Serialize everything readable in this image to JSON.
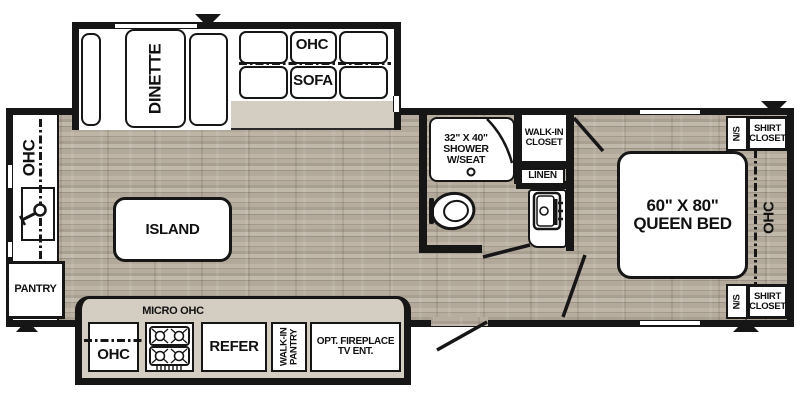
{
  "type": "rv-travel-trailer-floorplan",
  "colors": {
    "wall": "#161616",
    "floor_wood": "#b2a99c",
    "counter_tan": "#d4cec2",
    "interior_white": "#ffffff"
  },
  "labels": {
    "dinette": "DINETTE",
    "sofa_area": {
      "ohc": "OHC",
      "sofa": "SOFA"
    },
    "front": {
      "ohc": "OHC",
      "pantry": "PANTRY"
    },
    "kitchen": {
      "island": "ISLAND",
      "micro_ohc": "MICRO OHC",
      "ohc": "OHC",
      "refer": "REFER",
      "walk_in_pantry": [
        "WALK-IN",
        "PANTRY"
      ],
      "fireplace": [
        "OPT. FIREPLACE",
        "TV ENT."
      ]
    },
    "bathroom": {
      "shower": [
        "32\" X 40\"",
        "SHOWER",
        "W/SEAT"
      ],
      "walk_in_closet": [
        "WALK-IN",
        "CLOSET"
      ],
      "linen": "LINEN"
    },
    "bedroom": {
      "bed": [
        "60\" X 80\"",
        "QUEEN BED"
      ],
      "ohc": "OHC",
      "ns_top": "N/S",
      "ns_bottom": "N/S",
      "shirt_closet_top": [
        "SHIRT",
        "CLOSET"
      ],
      "shirt_closet_bottom": [
        "SHIRT",
        "CLOSET"
      ]
    }
  },
  "icons": {
    "slide_marker_top": "black triangle pointing down",
    "slide_marker_bedroom_top": "black triangle pointing down",
    "slide_marker_bedroom_bottom": "black triangle pointing up",
    "slide_marker_front": "black triangle pointing up",
    "toilet": "toilet bowl outline",
    "shower_drain": "small circle",
    "shower_curtain": "quarter arc",
    "kitchen_faucet": "lever faucet",
    "stove_burners": "4-burner cooktop grates",
    "vanity_sink": "sink basin with faucet knobs",
    "door_swing_entry": "diagonal door line",
    "door_swing_bathroom": "diagonal door line",
    "door_swing_bedroom": "diagonal door line",
    "door_swing_closet": "diagonal door line"
  }
}
